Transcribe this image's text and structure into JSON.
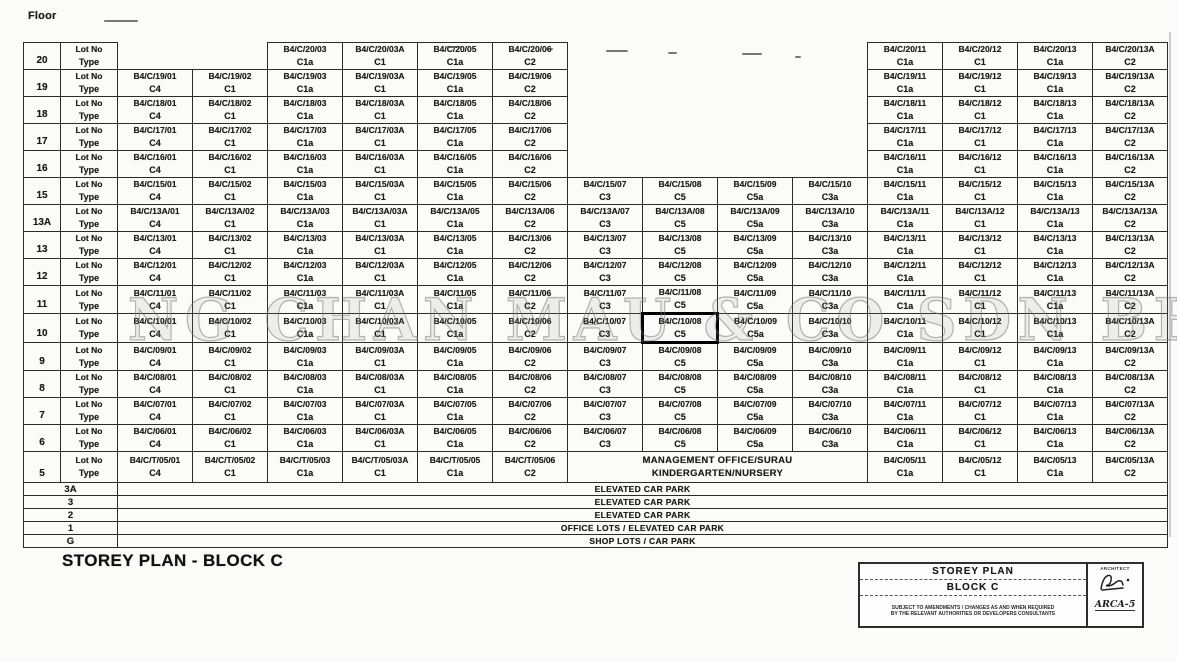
{
  "page": {
    "floor_header": "Floor",
    "title": "STOREY PLAN - BLOCK C",
    "watermark": "NG CHAN MAU & CO SDN BHD"
  },
  "labels": {
    "lot": "Lot No",
    "type": "Type"
  },
  "column_keys": [
    "01",
    "02",
    "03",
    "03A",
    "05",
    "06",
    "07",
    "08",
    "09",
    "10",
    "11",
    "12",
    "13",
    "13A"
  ],
  "floors": [
    {
      "floor": "20",
      "cells": {
        "03": {
          "lot": "B4/C/20/03",
          "type": "C1a"
        },
        "03A": {
          "lot": "B4/C/20/03A",
          "type": "C1"
        },
        "05": {
          "lot": "B4/C/20/05",
          "type": "C1a"
        },
        "06": {
          "lot": "B4/C/20/06",
          "type": "C2"
        },
        "11": {
          "lot": "B4/C/20/11",
          "type": "C1a"
        },
        "12": {
          "lot": "B4/C/20/12",
          "type": "C1"
        },
        "13": {
          "lot": "B4/C/20/13",
          "type": "C1a"
        },
        "13A": {
          "lot": "B4/C/20/13A",
          "type": "C2"
        }
      }
    },
    {
      "floor": "19",
      "cells": {
        "01": {
          "lot": "B4/C/19/01",
          "type": "C4"
        },
        "02": {
          "lot": "B4/C/19/02",
          "type": "C1"
        },
        "03": {
          "lot": "B4/C/19/03",
          "type": "C1a"
        },
        "03A": {
          "lot": "B4/C/19/03A",
          "type": "C1"
        },
        "05": {
          "lot": "B4/C/19/05",
          "type": "C1a"
        },
        "06": {
          "lot": "B4/C/19/06",
          "type": "C2"
        },
        "11": {
          "lot": "B4/C/19/11",
          "type": "C1a"
        },
        "12": {
          "lot": "B4/C/19/12",
          "type": "C1"
        },
        "13": {
          "lot": "B4/C/19/13",
          "type": "C1a"
        },
        "13A": {
          "lot": "B4/C/19/13A",
          "type": "C2"
        }
      }
    },
    {
      "floor": "18",
      "cells": {
        "01": {
          "lot": "B4/C/18/01",
          "type": "C4"
        },
        "02": {
          "lot": "B4/C/18/02",
          "type": "C1"
        },
        "03": {
          "lot": "B4/C/18/03",
          "type": "C1a"
        },
        "03A": {
          "lot": "B4/C/18/03A",
          "type": "C1"
        },
        "05": {
          "lot": "B4/C/18/05",
          "type": "C1a"
        },
        "06": {
          "lot": "B4/C/18/06",
          "type": "C2"
        },
        "11": {
          "lot": "B4/C/18/11",
          "type": "C1a"
        },
        "12": {
          "lot": "B4/C/18/12",
          "type": "C1"
        },
        "13": {
          "lot": "B4/C/18/13",
          "type": "C1a"
        },
        "13A": {
          "lot": "B4/C/18/13A",
          "type": "C2"
        }
      }
    },
    {
      "floor": "17",
      "cells": {
        "01": {
          "lot": "B4/C/17/01",
          "type": "C4"
        },
        "02": {
          "lot": "B4/C/17/02",
          "type": "C1"
        },
        "03": {
          "lot": "B4/C/17/03",
          "type": "C1a"
        },
        "03A": {
          "lot": "B4/C/17/03A",
          "type": "C1"
        },
        "05": {
          "lot": "B4/C/17/05",
          "type": "C1a"
        },
        "06": {
          "lot": "B4/C/17/06",
          "type": "C2"
        },
        "11": {
          "lot": "B4/C/17/11",
          "type": "C1a"
        },
        "12": {
          "lot": "B4/C/17/12",
          "type": "C1"
        },
        "13": {
          "lot": "B4/C/17/13",
          "type": "C1a"
        },
        "13A": {
          "lot": "B4/C/17/13A",
          "type": "C2"
        }
      }
    },
    {
      "floor": "16",
      "cells": {
        "01": {
          "lot": "B4/C/16/01",
          "type": "C4"
        },
        "02": {
          "lot": "B4/C/16/02",
          "type": "C1"
        },
        "03": {
          "lot": "B4/C/16/03",
          "type": "C1a"
        },
        "03A": {
          "lot": "B4/C/16/03A",
          "type": "C1"
        },
        "05": {
          "lot": "B4/C/16/05",
          "type": "C1a"
        },
        "06": {
          "lot": "B4/C/16/06",
          "type": "C2"
        },
        "11": {
          "lot": "B4/C/16/11",
          "type": "C1a"
        },
        "12": {
          "lot": "B4/C/16/12",
          "type": "C1"
        },
        "13": {
          "lot": "B4/C/16/13",
          "type": "C1a"
        },
        "13A": {
          "lot": "B4/C/16/13A",
          "type": "C2"
        }
      }
    },
    {
      "floor": "15",
      "cells": {
        "01": {
          "lot": "B4/C/15/01",
          "type": "C4"
        },
        "02": {
          "lot": "B4/C/15/02",
          "type": "C1"
        },
        "03": {
          "lot": "B4/C/15/03",
          "type": "C1a"
        },
        "03A": {
          "lot": "B4/C/15/03A",
          "type": "C1"
        },
        "05": {
          "lot": "B4/C/15/05",
          "type": "C1a"
        },
        "06": {
          "lot": "B4/C/15/06",
          "type": "C2"
        },
        "07": {
          "lot": "B4/C/15/07",
          "type": "C3"
        },
        "08": {
          "lot": "B4/C/15/08",
          "type": "C5"
        },
        "09": {
          "lot": "B4/C/15/09",
          "type": "C5a"
        },
        "10": {
          "lot": "B4/C/15/10",
          "type": "C3a"
        },
        "11": {
          "lot": "B4/C/15/11",
          "type": "C1a"
        },
        "12": {
          "lot": "B4/C/15/12",
          "type": "C1"
        },
        "13": {
          "lot": "B4/C/15/13",
          "type": "C1a"
        },
        "13A": {
          "lot": "B4/C/15/13A",
          "type": "C2"
        }
      }
    },
    {
      "floor": "13A",
      "cells": {
        "01": {
          "lot": "B4/C/13A/01",
          "type": "C4"
        },
        "02": {
          "lot": "B4/C/13A/02",
          "type": "C1"
        },
        "03": {
          "lot": "B4/C/13A/03",
          "type": "C1a"
        },
        "03A": {
          "lot": "B4/C/13A/03A",
          "type": "C1"
        },
        "05": {
          "lot": "B4/C/13A/05",
          "type": "C1a"
        },
        "06": {
          "lot": "B4/C/13A/06",
          "type": "C2"
        },
        "07": {
          "lot": "B4/C/13A/07",
          "type": "C3"
        },
        "08": {
          "lot": "B4/C/13A/08",
          "type": "C5"
        },
        "09": {
          "lot": "B4/C/13A/09",
          "type": "C5a"
        },
        "10": {
          "lot": "B4/C/13A/10",
          "type": "C3a"
        },
        "11": {
          "lot": "B4/C/13A/11",
          "type": "C1a"
        },
        "12": {
          "lot": "B4/C/13A/12",
          "type": "C1"
        },
        "13": {
          "lot": "B4/C/13A/13",
          "type": "C1a"
        },
        "13A": {
          "lot": "B4/C/13A/13A",
          "type": "C2"
        }
      }
    },
    {
      "floor": "13",
      "cells": {
        "01": {
          "lot": "B4/C/13/01",
          "type": "C4"
        },
        "02": {
          "lot": "B4/C/13/02",
          "type": "C1"
        },
        "03": {
          "lot": "B4/C/13/03",
          "type": "C1a"
        },
        "03A": {
          "lot": "B4/C/13/03A",
          "type": "C1"
        },
        "05": {
          "lot": "B4/C/13/05",
          "type": "C1a"
        },
        "06": {
          "lot": "B4/C/13/06",
          "type": "C2"
        },
        "07": {
          "lot": "B4/C/13/07",
          "type": "C3"
        },
        "08": {
          "lot": "B4/C/13/08",
          "type": "C5"
        },
        "09": {
          "lot": "B4/C/13/09",
          "type": "C5a"
        },
        "10": {
          "lot": "B4/C/13/10",
          "type": "C3a"
        },
        "11": {
          "lot": "B4/C/13/11",
          "type": "C1a"
        },
        "12": {
          "lot": "B4/C/13/12",
          "type": "C1"
        },
        "13": {
          "lot": "B4/C/13/13",
          "type": "C1a"
        },
        "13A": {
          "lot": "B4/C/13/13A",
          "type": "C2"
        }
      }
    },
    {
      "floor": "12",
      "cells": {
        "01": {
          "lot": "B4/C/12/01",
          "type": "C4"
        },
        "02": {
          "lot": "B4/C/12/02",
          "type": "C1"
        },
        "03": {
          "lot": "B4/C/12/03",
          "type": "C1a"
        },
        "03A": {
          "lot": "B4/C/12/03A",
          "type": "C1"
        },
        "05": {
          "lot": "B4/C/12/05",
          "type": "C1a"
        },
        "06": {
          "lot": "B4/C/12/06",
          "type": "C2"
        },
        "07": {
          "lot": "B4/C/12/07",
          "type": "C3"
        },
        "08": {
          "lot": "B4/C/12/08",
          "type": "C5"
        },
        "09": {
          "lot": "B4/C/12/09",
          "type": "C5a"
        },
        "10": {
          "lot": "B4/C/12/10",
          "type": "C3a"
        },
        "11": {
          "lot": "B4/C/12/11",
          "type": "C1a"
        },
        "12": {
          "lot": "B4/C/12/12",
          "type": "C1"
        },
        "13": {
          "lot": "B4/C/12/13",
          "type": "C1a"
        },
        "13A": {
          "lot": "B4/C/12/13A",
          "type": "C2"
        }
      }
    },
    {
      "floor": "11",
      "cells": {
        "01": {
          "lot": "B4/C/11/01",
          "type": "C4"
        },
        "02": {
          "lot": "B4/C/11/02",
          "type": "C1"
        },
        "03": {
          "lot": "B4/C/11/03",
          "type": "C1a"
        },
        "03A": {
          "lot": "B4/C/11/03A",
          "type": "C1"
        },
        "05": {
          "lot": "B4/C/11/05",
          "type": "C1a"
        },
        "06": {
          "lot": "B4/C/11/06",
          "type": "C2"
        },
        "07": {
          "lot": "B4/C/11/07",
          "type": "C3"
        },
        "08": {
          "lot": "B4/C/11/08",
          "type": "C5"
        },
        "09": {
          "lot": "B4/C/11/09",
          "type": "C5a"
        },
        "10": {
          "lot": "B4/C/11/10",
          "type": "C3a"
        },
        "11": {
          "lot": "B4/C/11/11",
          "type": "C1a"
        },
        "12": {
          "lot": "B4/C/11/12",
          "type": "C1"
        },
        "13": {
          "lot": "B4/C/11/13",
          "type": "C1a"
        },
        "13A": {
          "lot": "B4/C/11/13A",
          "type": "C2"
        }
      }
    },
    {
      "floor": "10",
      "highlight": "08",
      "cells": {
        "01": {
          "lot": "B4/C/10/01",
          "type": "C4"
        },
        "02": {
          "lot": "B4/C/10/02",
          "type": "C1"
        },
        "03": {
          "lot": "B4/C/10/03",
          "type": "C1a"
        },
        "03A": {
          "lot": "B4/C/10/03A",
          "type": "C1"
        },
        "05": {
          "lot": "B4/C/10/05",
          "type": "C1a"
        },
        "06": {
          "lot": "B4/C/10/06",
          "type": "C2"
        },
        "07": {
          "lot": "B4/C/10/07",
          "type": "C3"
        },
        "08": {
          "lot": "B4/C/10/08",
          "type": "C5"
        },
        "09": {
          "lot": "B4/C/10/09",
          "type": "C5a"
        },
        "10": {
          "lot": "B4/C/10/10",
          "type": "C3a"
        },
        "11": {
          "lot": "B4/C/10/11",
          "type": "C1a"
        },
        "12": {
          "lot": "B4/C/10/12",
          "type": "C1"
        },
        "13": {
          "lot": "B4/C/10/13",
          "type": "C1a"
        },
        "13A": {
          "lot": "B4/C/10/13A",
          "type": "C2"
        }
      }
    },
    {
      "floor": "9",
      "cells": {
        "01": {
          "lot": "B4/C/09/01",
          "type": "C4"
        },
        "02": {
          "lot": "B4/C/09/02",
          "type": "C1"
        },
        "03": {
          "lot": "B4/C/09/03",
          "type": "C1a"
        },
        "03A": {
          "lot": "B4/C/09/03A",
          "type": "C1"
        },
        "05": {
          "lot": "B4/C/09/05",
          "type": "C1a"
        },
        "06": {
          "lot": "B4/C/09/06",
          "type": "C2"
        },
        "07": {
          "lot": "B4/C/09/07",
          "type": "C3"
        },
        "08": {
          "lot": "B4/C/09/08",
          "type": "C5"
        },
        "09": {
          "lot": "B4/C/09/09",
          "type": "C5a"
        },
        "10": {
          "lot": "B4/C/09/10",
          "type": "C3a"
        },
        "11": {
          "lot": "B4/C/09/11",
          "type": "C1a"
        },
        "12": {
          "lot": "B4/C/09/12",
          "type": "C1"
        },
        "13": {
          "lot": "B4/C/09/13",
          "type": "C1a"
        },
        "13A": {
          "lot": "B4/C/09/13A",
          "type": "C2"
        }
      }
    },
    {
      "floor": "8",
      "cells": {
        "01": {
          "lot": "B4/C/08/01",
          "type": "C4"
        },
        "02": {
          "lot": "B4/C/08/02",
          "type": "C1"
        },
        "03": {
          "lot": "B4/C/08/03",
          "type": "C1a"
        },
        "03A": {
          "lot": "B4/C/08/03A",
          "type": "C1"
        },
        "05": {
          "lot": "B4/C/08/05",
          "type": "C1a"
        },
        "06": {
          "lot": "B4/C/08/06",
          "type": "C2"
        },
        "07": {
          "lot": "B4/C/08/07",
          "type": "C3"
        },
        "08": {
          "lot": "B4/C/08/08",
          "type": "C5"
        },
        "09": {
          "lot": "B4/C/08/09",
          "type": "C5a"
        },
        "10": {
          "lot": "B4/C/08/10",
          "type": "C3a"
        },
        "11": {
          "lot": "B4/C/08/11",
          "type": "C1a"
        },
        "12": {
          "lot": "B4/C/08/12",
          "type": "C1"
        },
        "13": {
          "lot": "B4/C/08/13",
          "type": "C1a"
        },
        "13A": {
          "lot": "B4/C/08/13A",
          "type": "C2"
        }
      }
    },
    {
      "floor": "7",
      "cells": {
        "01": {
          "lot": "B4/C/07/01",
          "type": "C4"
        },
        "02": {
          "lot": "B4/C/07/02",
          "type": "C1"
        },
        "03": {
          "lot": "B4/C/07/03",
          "type": "C1a"
        },
        "03A": {
          "lot": "B4/C/07/03A",
          "type": "C1"
        },
        "05": {
          "lot": "B4/C/07/05",
          "type": "C1a"
        },
        "06": {
          "lot": "B4/C/07/06",
          "type": "C2"
        },
        "07": {
          "lot": "B4/C/07/07",
          "type": "C3"
        },
        "08": {
          "lot": "B4/C/07/08",
          "type": "C5"
        },
        "09": {
          "lot": "B4/C/07/09",
          "type": "C5a"
        },
        "10": {
          "lot": "B4/C/07/10",
          "type": "C3a"
        },
        "11": {
          "lot": "B4/C/07/11",
          "type": "C1a"
        },
        "12": {
          "lot": "B4/C/07/12",
          "type": "C1"
        },
        "13": {
          "lot": "B4/C/07/13",
          "type": "C1a"
        },
        "13A": {
          "lot": "B4/C/07/13A",
          "type": "C2"
        }
      }
    },
    {
      "floor": "6",
      "cells": {
        "01": {
          "lot": "B4/C/06/01",
          "type": "C4"
        },
        "02": {
          "lot": "B4/C/06/02",
          "type": "C1"
        },
        "03": {
          "lot": "B4/C/06/03",
          "type": "C1a"
        },
        "03A": {
          "lot": "B4/C/06/03A",
          "type": "C1"
        },
        "05": {
          "lot": "B4/C/06/05",
          "type": "C1a"
        },
        "06": {
          "lot": "B4/C/06/06",
          "type": "C2"
        },
        "07": {
          "lot": "B4/C/06/07",
          "type": "C3"
        },
        "08": {
          "lot": "B4/C/06/08",
          "type": "C5"
        },
        "09": {
          "lot": "B4/C/06/09",
          "type": "C5a"
        },
        "10": {
          "lot": "B4/C/06/10",
          "type": "C3a"
        },
        "11": {
          "lot": "B4/C/06/11",
          "type": "C1a"
        },
        "12": {
          "lot": "B4/C/06/12",
          "type": "C1"
        },
        "13": {
          "lot": "B4/C/06/13",
          "type": "C1a"
        },
        "13A": {
          "lot": "B4/C/06/13A",
          "type": "C2"
        }
      }
    },
    {
      "floor": "5",
      "tall": true,
      "merge": {
        "cols": [
          "07",
          "08",
          "09",
          "10"
        ],
        "line1": "MANAGEMENT OFFICE/SURAU",
        "line2": "KINDERGARTEN/NURSERY"
      },
      "cells": {
        "01": {
          "lot": "B4/C/T/05/01",
          "type": "C4"
        },
        "02": {
          "lot": "B4/C/T/05/02",
          "type": "C1"
        },
        "03": {
          "lot": "B4/C/T/05/03",
          "type": "C1a"
        },
        "03A": {
          "lot": "B4/C/T/05/03A",
          "type": "C1"
        },
        "05": {
          "lot": "B4/C/T/05/05",
          "type": "C1a"
        },
        "06": {
          "lot": "B4/C/T/05/06",
          "type": "C2"
        },
        "11": {
          "lot": "B4/C/05/11",
          "type": "C1a"
        },
        "12": {
          "lot": "B4/C/05/12",
          "type": "C1"
        },
        "13": {
          "lot": "B4/C/05/13",
          "type": "C1a"
        },
        "13A": {
          "lot": "B4/C/05/13A",
          "type": "C2"
        }
      }
    }
  ],
  "special_rows": [
    {
      "floor": "3A",
      "label": "ELEVATED CAR PARK"
    },
    {
      "floor": "3",
      "label": "ELEVATED CAR PARK"
    },
    {
      "floor": "2",
      "label": "ELEVATED CAR PARK"
    },
    {
      "floor": "1",
      "label": "OFFICE LOTS / ELEVATED CAR PARK"
    },
    {
      "floor": "G",
      "label": "SHOP LOTS / CAR PARK"
    }
  ],
  "title_block": {
    "title": "STOREY PLAN",
    "subtitle": "BLOCK C",
    "note_line1": "SUBJECT TO AMENDMENTS / CHANGES AS AND WHEN REQUIRED",
    "note_line2": "BY THE RELEVANT AUTHORITIES OR DEVELOPERS CONSULTANTS",
    "architect_label": "ARCHITECT",
    "architect_code": "ARCA-5"
  }
}
